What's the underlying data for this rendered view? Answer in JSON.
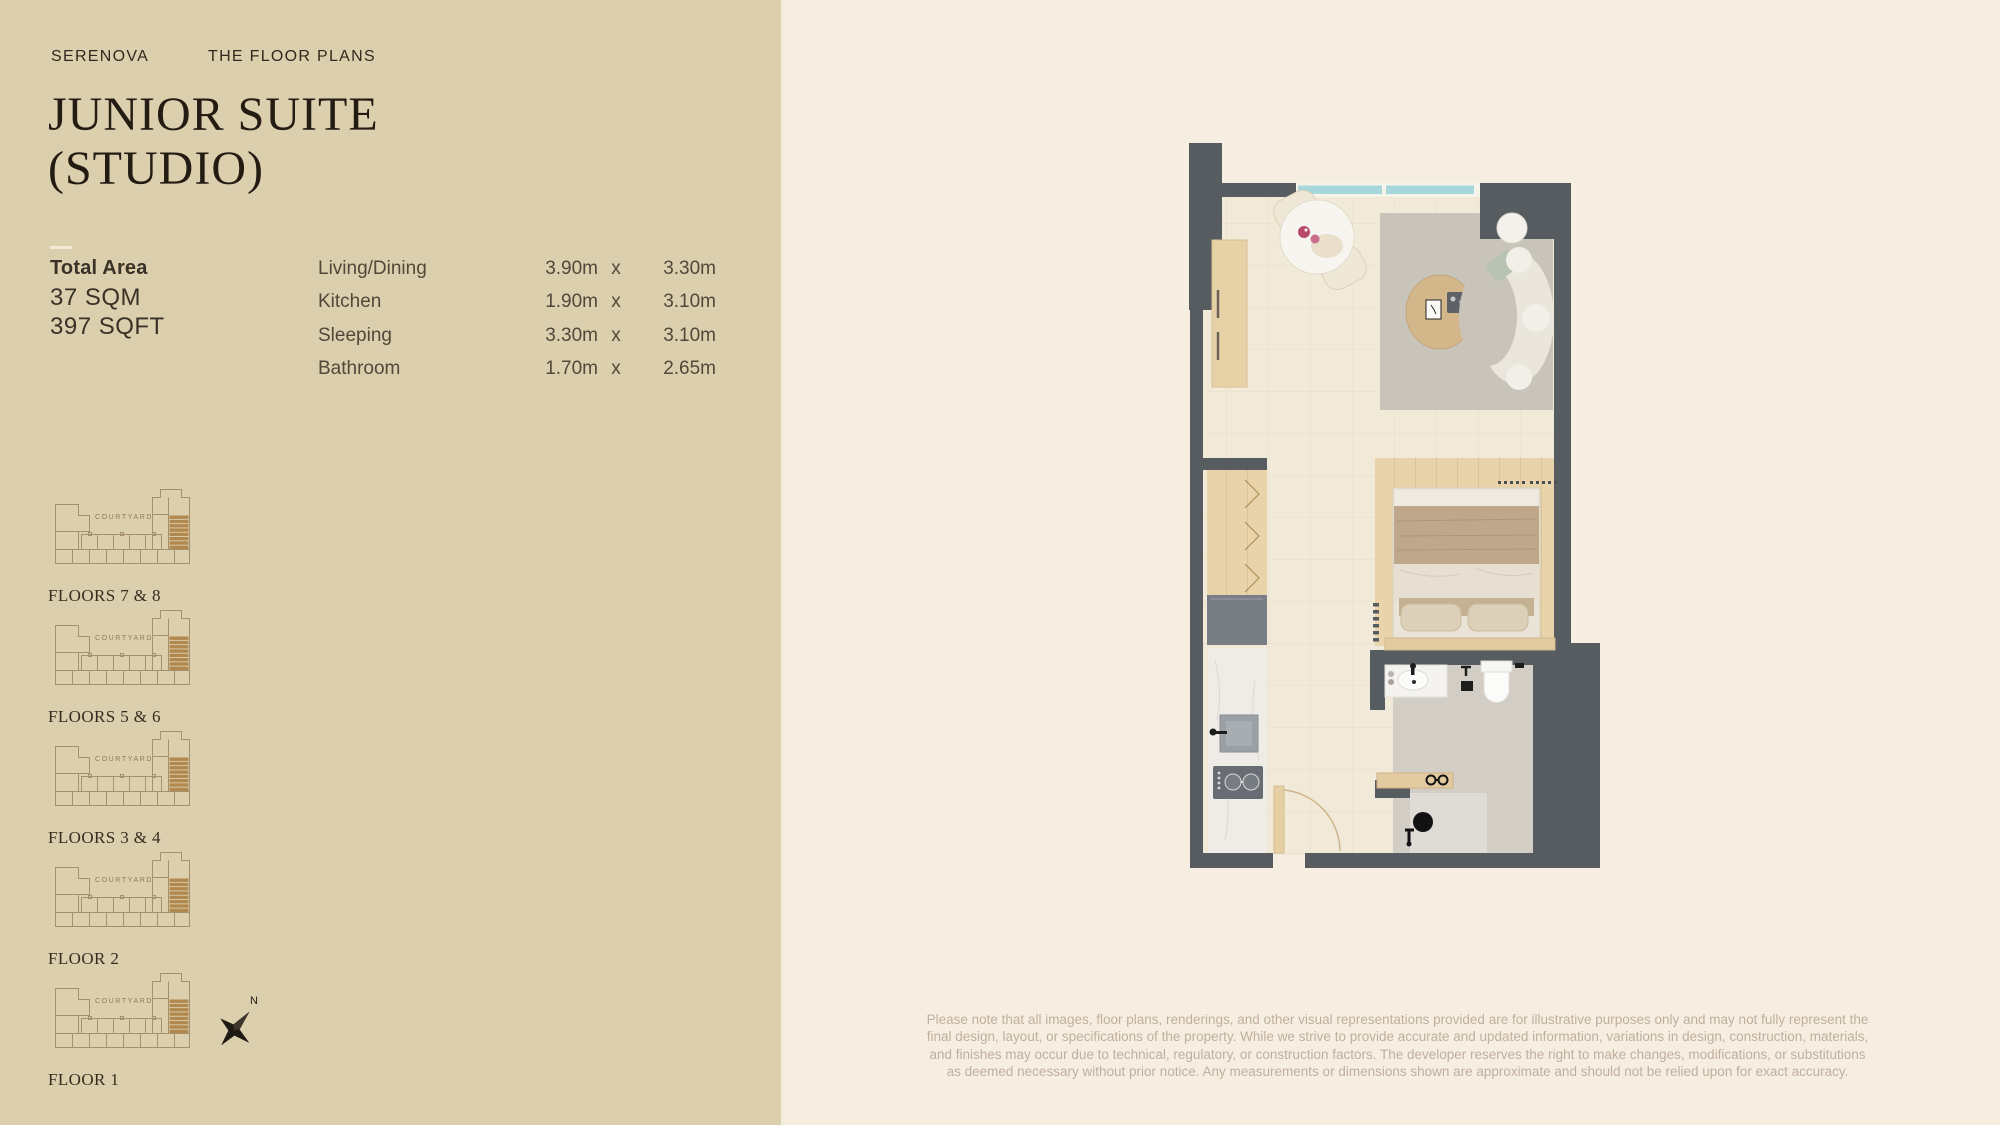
{
  "page": {
    "brand": "SERENOVA",
    "section": "THE FLOOR PLANS",
    "title_line1": "JUNIOR SUITE",
    "title_line2": "(STUDIO)",
    "total_area_label": "Total Area",
    "total_area_sqm": "37 SQM",
    "total_area_sqft": "397 SQFT"
  },
  "dimensions": {
    "rows": [
      {
        "label": "Living/Dining",
        "w": "3.90m",
        "x": "x",
        "h": "3.30m"
      },
      {
        "label": "Kitchen",
        "w": "1.90m",
        "x": "x",
        "h": "3.10m"
      },
      {
        "label": "Sleeping",
        "w": "3.30m",
        "x": "x",
        "h": "3.10m"
      },
      {
        "label": "Bathroom",
        "w": "1.70m",
        "x": "x",
        "h": "2.65m"
      }
    ]
  },
  "key_plans": {
    "courtyard_label": "COURTYARD",
    "compass_label": "N",
    "items": [
      {
        "caption": "FLOORS 7 & 8"
      },
      {
        "caption": "FLOORS 5 & 6"
      },
      {
        "caption": "FLOORS 3 & 4"
      },
      {
        "caption": "FLOOR 2"
      },
      {
        "caption": "FLOOR 1"
      }
    ]
  },
  "disclaimer": {
    "lines": [
      "Please note that all images, floor plans, renderings, and other visual representations provided are for illustrative purposes only and may not fully represent the",
      "final design, layout, or specifications of the property. While we strive to provide accurate and updated information, variations in design, construction, materials,",
      "and finishes may occur due to technical, regulatory, or construction factors. The developer reserves the right to make changes, modifications, or substitutions",
      "as deemed necessary without prior notice. Any measurements or dimensions shown are approximate and should not be relied upon for exact accuracy."
    ]
  },
  "colors": {
    "left_panel_bg": "#dccfae",
    "right_panel_bg": "#f7eee2",
    "wall": "#575c61",
    "window": "#a7d7da",
    "keyplan_outline": "#a4906a",
    "keyplan_highlight": "#b1884e",
    "title_text": "#241c12",
    "disclaimer_text": "#c0af9d"
  }
}
